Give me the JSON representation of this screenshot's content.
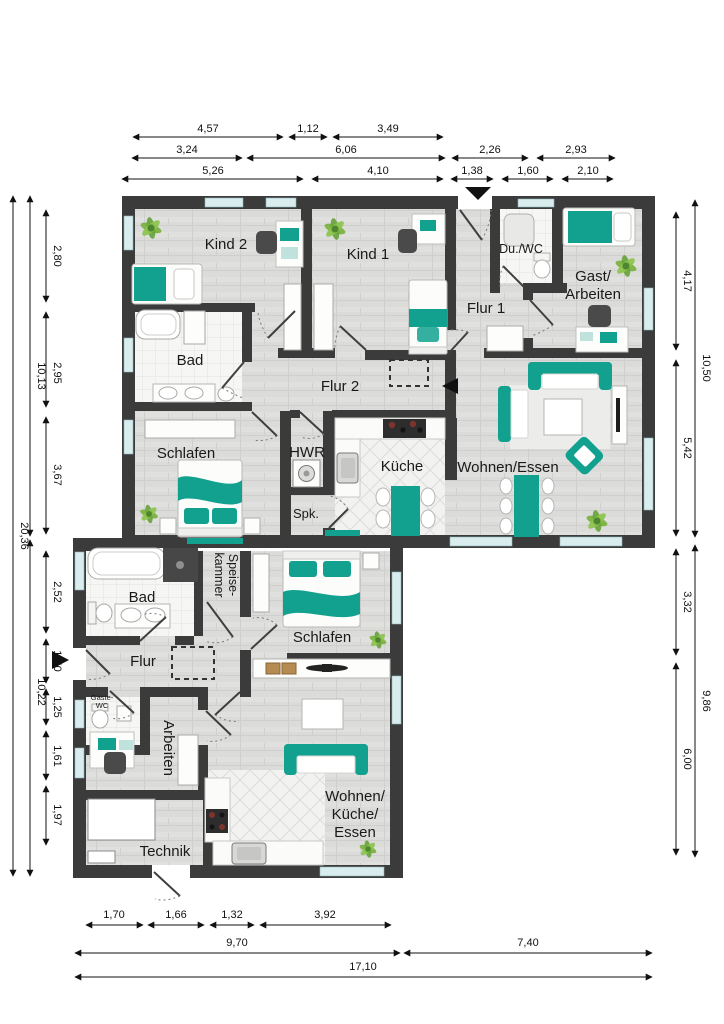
{
  "rooms": {
    "kind2": "Kind 2",
    "kind1": "Kind 1",
    "duwc": "Du./WC",
    "gast_line1": "Gast/",
    "gast_line2": "Arbeiten",
    "flur1": "Flur 1",
    "bad_og": "Bad",
    "flur2": "Flur 2",
    "schlafen_a": "Schlafen",
    "hwr": "HWR",
    "spk": "Spk.",
    "kueche": "Küche",
    "wohnen_essen": "Wohnen/Essen",
    "bad_b": "Bad",
    "speise_line1": "Speise-",
    "speise_line2": "kammer",
    "schlafen_b": "Schlafen",
    "flur": "Flur",
    "gaeste_line1": "Gäste-",
    "gaeste_line2": "WC",
    "arbeiten": "Arbeiten",
    "technik": "Technik",
    "wke_line1": "Wohnen/",
    "wke_line2": "Küche/",
    "wke_line3": "Essen"
  },
  "dims": {
    "top1": [
      "4,57",
      "1,12",
      "3,49"
    ],
    "top2": [
      "3,24",
      "6,06",
      "2,26",
      "2,93"
    ],
    "top3": [
      "5,26",
      "4,10",
      "1,38",
      "1,60",
      "2,10"
    ],
    "bottom1": [
      "1,70",
      "1,66",
      "1,32",
      "3,92"
    ],
    "bottom2": [
      "9,70",
      "7,40"
    ],
    "bottom3": [
      "17,10"
    ],
    "left_inner": [
      "2,80",
      "2,95",
      "3,67",
      "2,52",
      "1,50",
      "1,25",
      "1,61",
      "1,97"
    ],
    "left_mid": [
      "10,13",
      "10,22"
    ],
    "left_outer": [
      "20,36"
    ],
    "right_inner": [
      "4,17",
      "5,42",
      "3,32",
      "6,00"
    ],
    "right_outer": [
      "10,50",
      "9,86"
    ]
  },
  "colors": {
    "wall": "#3b3b3b",
    "accent_teal": "#12a18e",
    "teal_light": "#bfe3dc",
    "window": "#d9ecee",
    "plant_green": "#7cb342"
  }
}
